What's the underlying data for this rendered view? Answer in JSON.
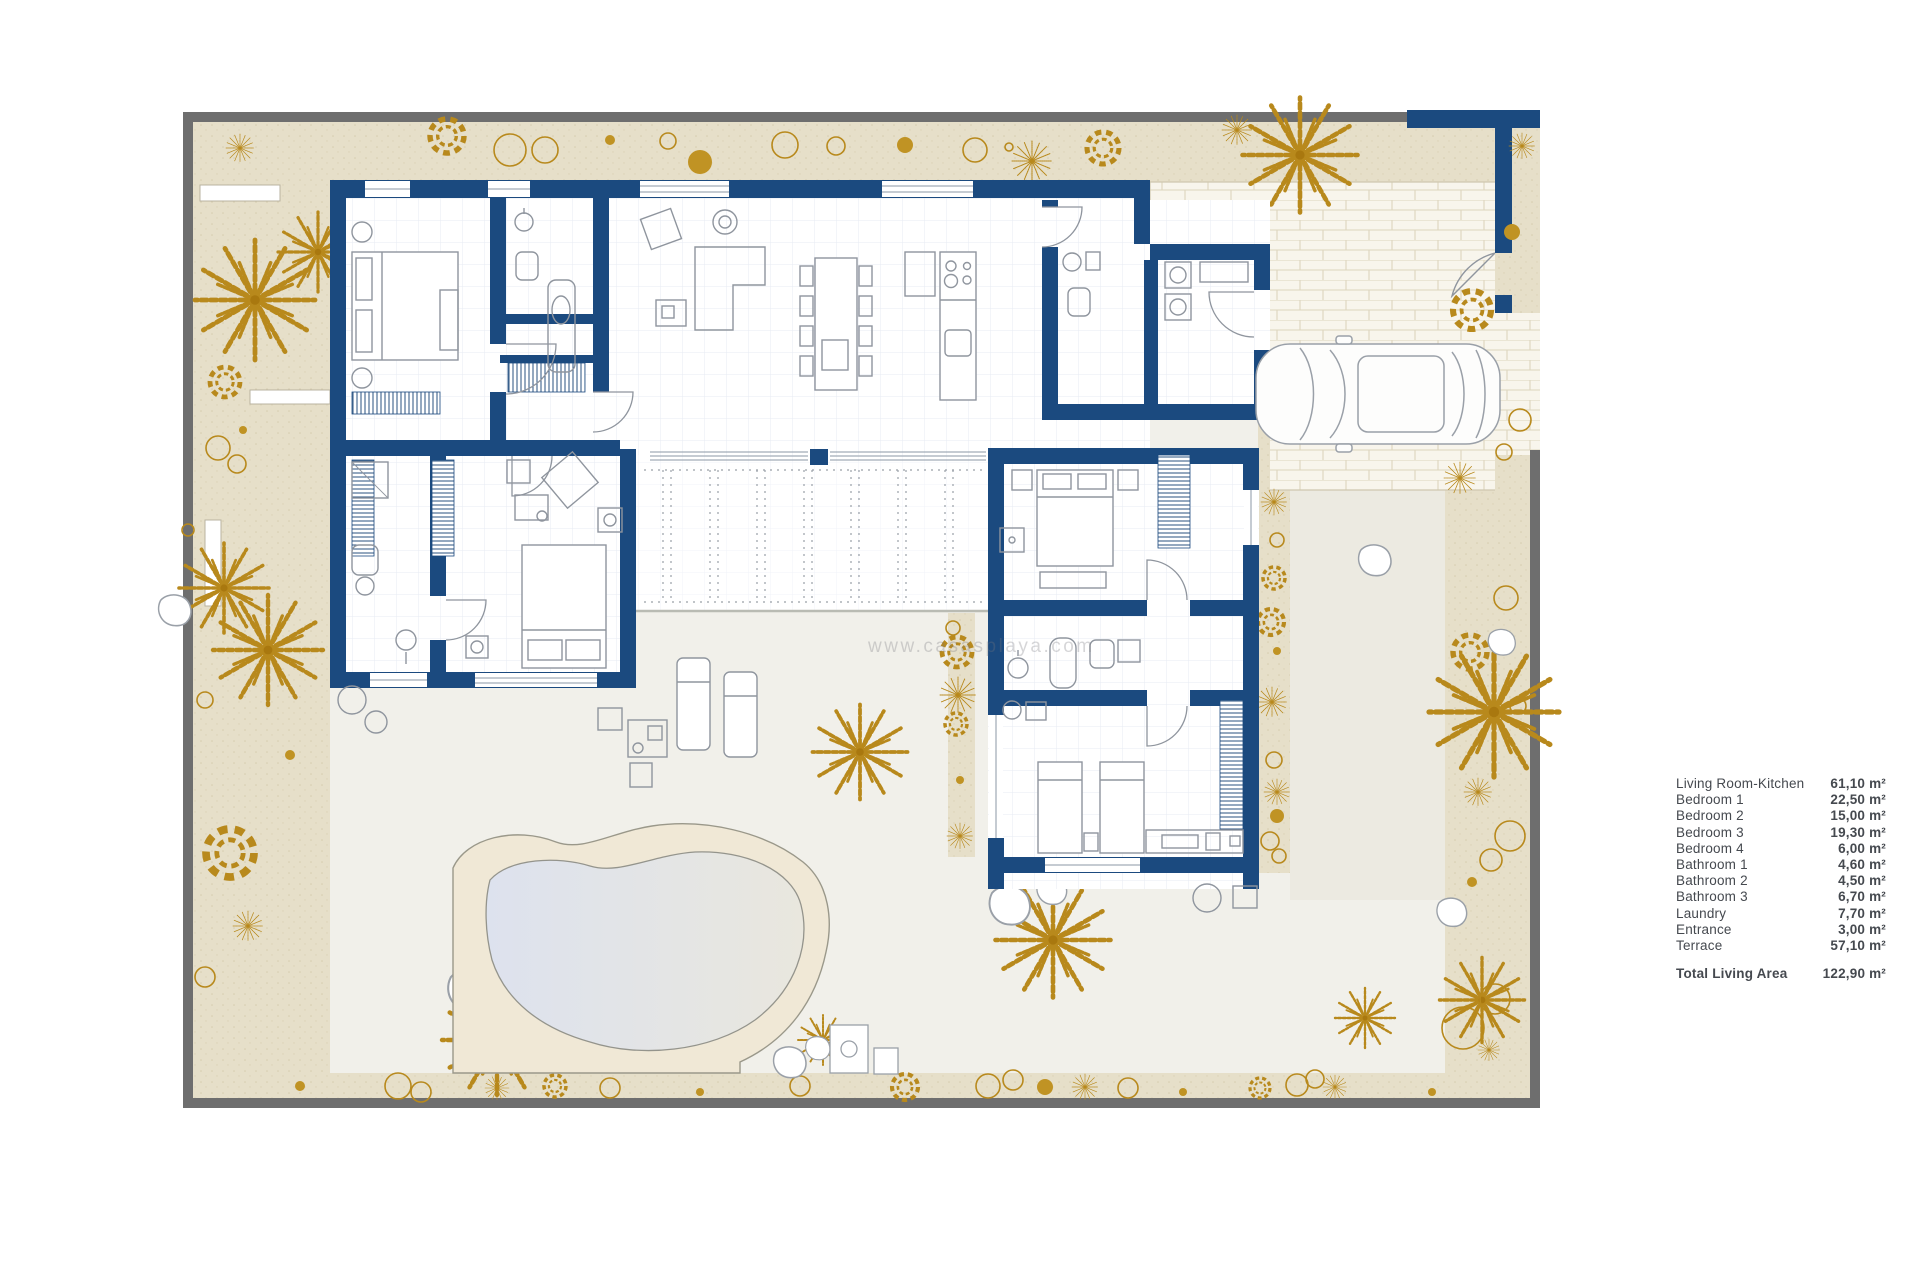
{
  "legend": {
    "rows": [
      {
        "label": "Living Room-Kitchen",
        "value": "61,10  m²"
      },
      {
        "label": "Bedroom 1",
        "value": "22,50 m²"
      },
      {
        "label": "Bedroom  2",
        "value": "15,00 m²"
      },
      {
        "label": "Bedroom  3",
        "value": "19,30 m²"
      },
      {
        "label": "Bedroom  4",
        "value": "6,00 m²"
      },
      {
        "label": "Bathroom 1",
        "value": "4,60 m²"
      },
      {
        "label": "Bathroom 2",
        "value": "4,50 m²"
      },
      {
        "label": "Bathroom 3",
        "value": "6,70 m²"
      },
      {
        "label": "Laundry",
        "value": "7,70 m²"
      },
      {
        "label": "Entrance",
        "value": "3,00 m²"
      },
      {
        "label": "Terrace",
        "value": "57,10 m²"
      }
    ],
    "total": {
      "label": "Total Living Area",
      "value": "122,90 m²"
    }
  },
  "watermark": "www.casasplaya.com",
  "colors": {
    "wall_blue": "#1b4a7f",
    "garden_beige": "#e6dfc9",
    "plant_gold": "#b8891c",
    "terrace": "#f1f0ea",
    "pool_water": "#dfe3ec",
    "pool_deck": "#f0e8d6",
    "plot_border_grey": "#6e6e6e"
  }
}
